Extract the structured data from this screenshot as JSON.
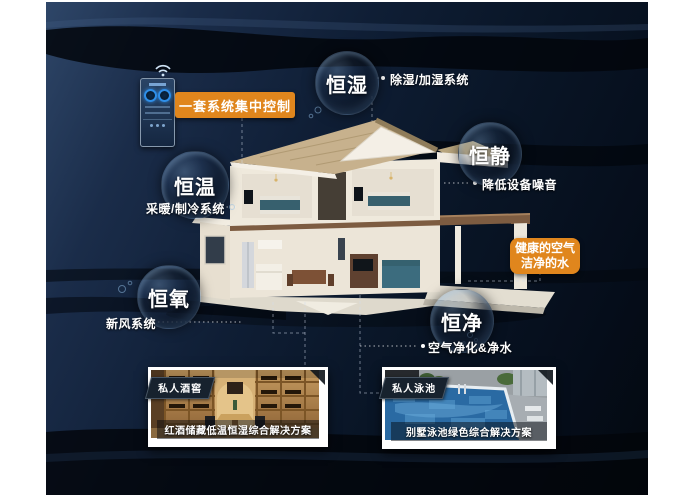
{
  "poster": {
    "control_panel": {
      "label": "一套系统集中控制",
      "device": "smart-control-panel",
      "icons": [
        {
          "name": "wifi-icon",
          "shape": "three-arcs"
        }
      ]
    },
    "bubbles": [
      {
        "key": "humidity",
        "label": "恒湿",
        "annotation": "除湿/加湿系统"
      },
      {
        "key": "quiet",
        "label": "恒静",
        "annotation": "降低设备噪音"
      },
      {
        "key": "temperature",
        "label": "恒温",
        "annotation": "采暖/制冷系统"
      },
      {
        "key": "oxygen",
        "label": "恒氧",
        "annotation": "新风系统"
      },
      {
        "key": "purity",
        "label": "恒净",
        "annotation": "空气净化&净水"
      }
    ],
    "highlight_box": {
      "line1": "健康的空气",
      "line2": "洁净的水"
    },
    "cards": [
      {
        "key": "wine-cellar",
        "badge": "私人酒窖",
        "caption": "红酒储藏低温恒湿综合解决方案"
      },
      {
        "key": "pool",
        "badge": "私人泳池",
        "caption": "别墅泳池绿色综合解决方案"
      }
    ],
    "colors": {
      "accent_orange": "#e0861d",
      "background_navy": "#0f1e35",
      "bubble_rim": "#96bee6",
      "roof_tan": "#c7b18d",
      "pool_blue": "#2a6aa3",
      "wood_brown": "#b08040"
    }
  }
}
